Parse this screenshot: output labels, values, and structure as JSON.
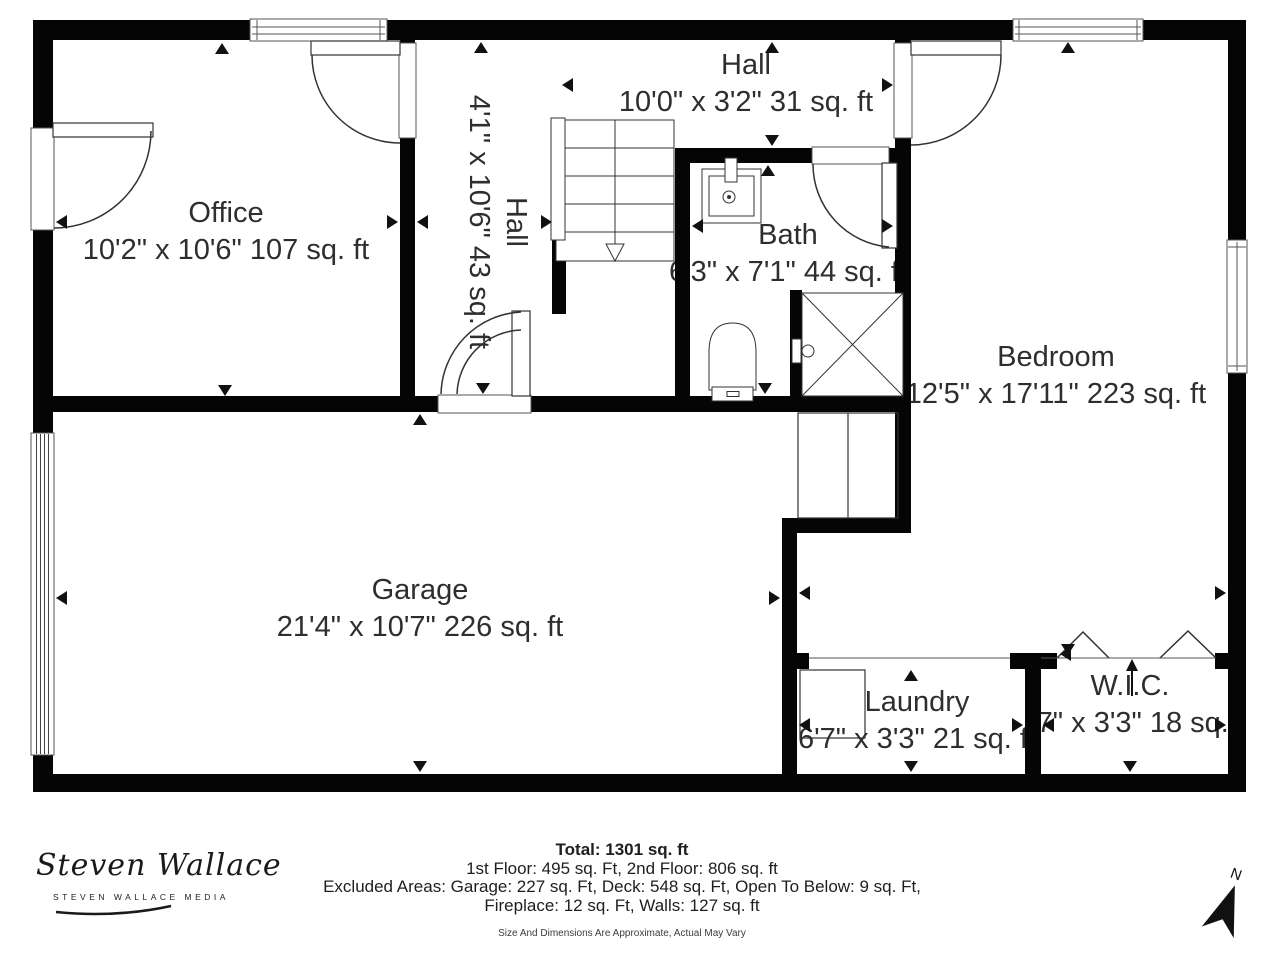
{
  "rooms": {
    "office": {
      "name": "Office",
      "dims": "10'2\" x 10'6\" 107 sq. ft"
    },
    "hall_upper": {
      "name": "Hall",
      "dims": "10'0\" x 3'2\" 31 sq. ft"
    },
    "hall_stairs": {
      "name": "Hall",
      "dims": "4'1\" x 10'6\" 43 sq. ft"
    },
    "bath": {
      "name": "Bath",
      "dims": "6'3\" x 7'1\" 44 sq. ft"
    },
    "bedroom": {
      "name": "Bedroom",
      "dims": "12'5\" x 17'11\" 223 sq. ft"
    },
    "garage": {
      "name": "Garage",
      "dims": "21'4\" x 10'7\" 226 sq. ft"
    },
    "laundry": {
      "name": "Laundry",
      "dims": "6'7\" x 3'3\" 21 sq. ft"
    },
    "wic": {
      "name": "W.I.C.",
      "dims": "5'7\" x 3'3\" 18 sq. ft"
    }
  },
  "summary": {
    "total": "Total: 1301 sq. ft",
    "floors": "1st Floor: 495 sq. Ft, 2nd Floor: 806 sq. ft",
    "excluded_line1": "Excluded Areas: Garage: 227 sq. Ft, Deck: 548 sq. Ft, Open To Below: 9 sq. Ft,",
    "excluded_line2": "Fireplace: 12 sq. Ft, Walls: 127 sq. ft",
    "disclaimer": "Size And Dimensions Are Approximate, Actual May Vary"
  },
  "branding": {
    "logo_script": "Steven Wallace",
    "logo_sub": "STEVEN WALLACE MEDIA"
  },
  "compass": {
    "label": "N"
  },
  "colors": {
    "wall": "#050505",
    "line": "#333333",
    "text": "#2e2e2e"
  }
}
